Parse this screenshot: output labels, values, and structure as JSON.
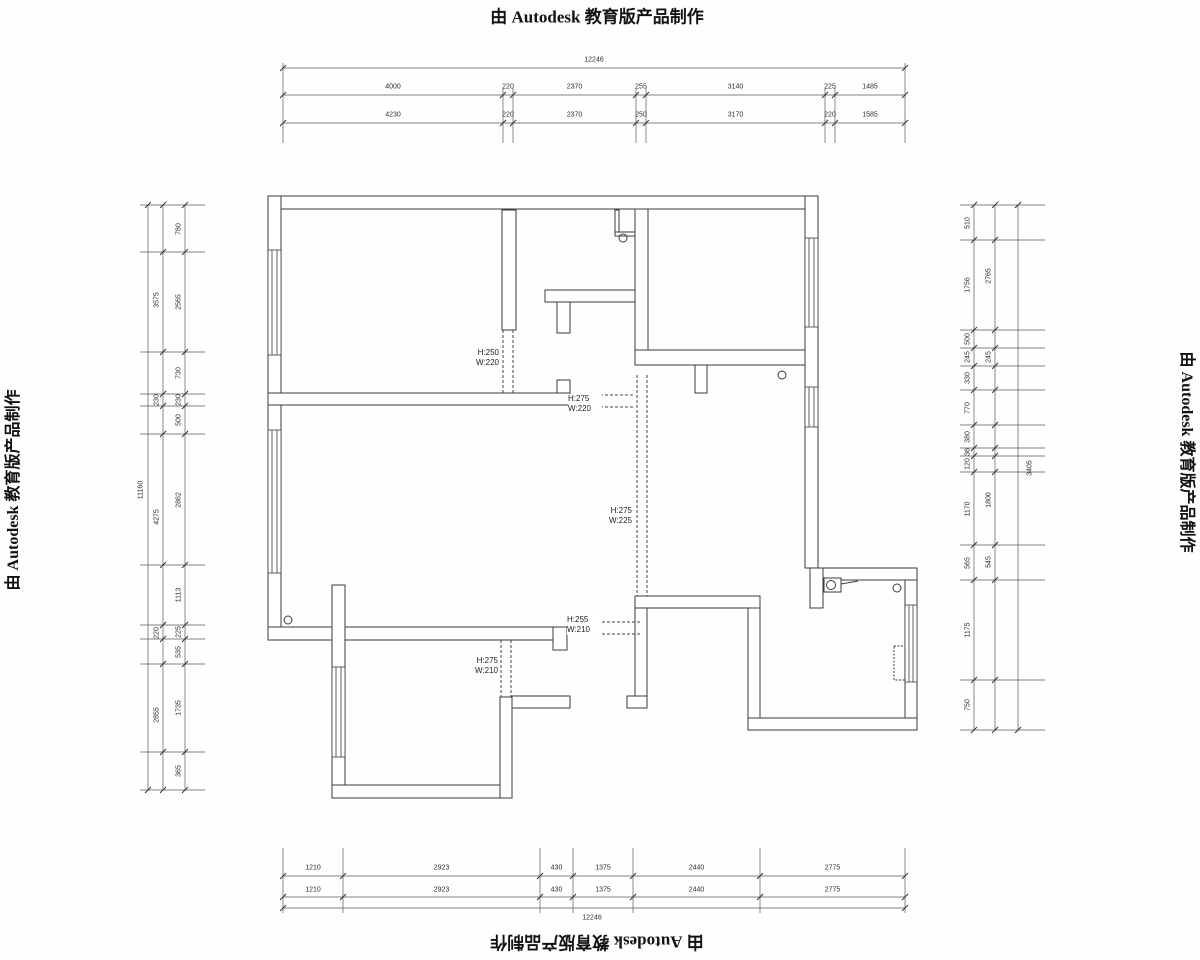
{
  "watermark": {
    "text": "由 Autodesk 教育版产品制作"
  },
  "plan": {
    "openings": [
      {
        "id": "opening-top-left-room",
        "h": "H:250",
        "w": "W:220"
      },
      {
        "id": "opening-upper-middle",
        "h": "H:275",
        "w": "W:220"
      },
      {
        "id": "opening-hallway",
        "h": "H:275",
        "w": "W:225"
      },
      {
        "id": "opening-lower-middle",
        "h": "H:255",
        "w": "W:210"
      },
      {
        "id": "opening-bottom-left-room",
        "h": "H:275",
        "w": "W:210"
      }
    ]
  },
  "dimensions": {
    "top": {
      "total": "12246",
      "row1": [
        "4000",
        "220",
        "2370",
        "255",
        "3140",
        "225",
        "1485"
      ],
      "row2": [
        "4230",
        "220",
        "2370",
        "250",
        "3170",
        "220",
        "1585"
      ]
    },
    "bottom": {
      "total": "12246",
      "row1": [
        "1210",
        "2923",
        "430",
        "1375",
        "2440",
        "2775"
      ],
      "row2": [
        "1210",
        "2923",
        "430",
        "1375",
        "2440",
        "2775"
      ]
    },
    "left": {
      "total": "11160",
      "outer": [
        "3575",
        "230",
        "4275",
        "220",
        "2855"
      ],
      "inner": [
        "780",
        "2565",
        "730",
        "230",
        "500",
        "2862",
        "1113",
        "225",
        "535",
        "1735",
        "365"
      ]
    },
    "right": {
      "total": "3405",
      "outer": [
        "2765",
        "245",
        "1800",
        "545"
      ],
      "inner": [
        "510",
        "1756",
        "500",
        "245",
        "330",
        "770",
        "380",
        "36",
        "120",
        "1170",
        "565",
        "1175",
        "750"
      ]
    }
  }
}
